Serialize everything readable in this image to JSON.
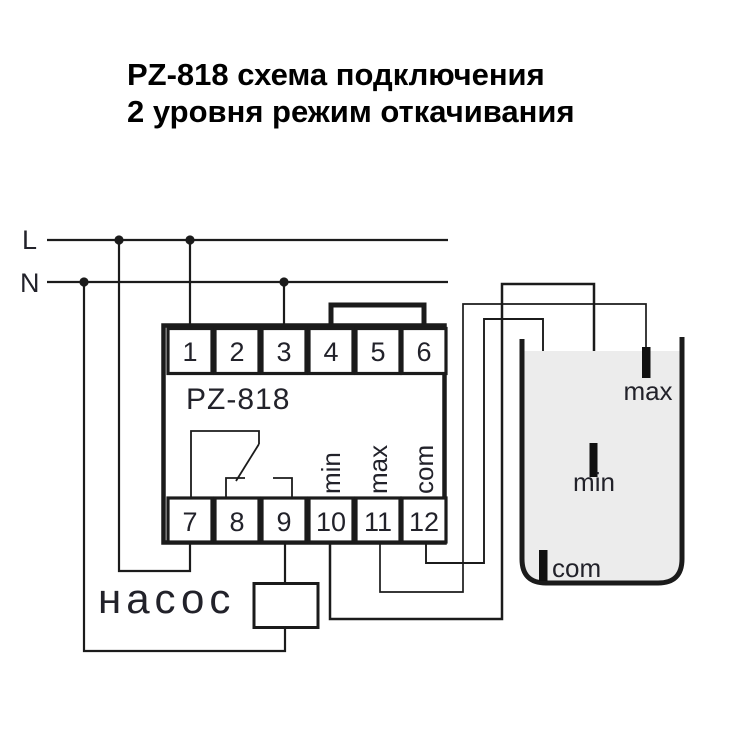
{
  "title": {
    "line1": "PZ-818 схема подключения",
    "line2": "2 уровня режим откачивания"
  },
  "power": {
    "l": "L",
    "n": "N"
  },
  "device": {
    "model": "PZ-818",
    "terminals_top": [
      "1",
      "2",
      "3",
      "4",
      "5",
      "6"
    ],
    "terminals_bottom": [
      "7",
      "8",
      "9",
      "10",
      "11",
      "12"
    ],
    "signals": [
      "min",
      "max",
      "com"
    ]
  },
  "pump": {
    "label": "насос"
  },
  "tank": {
    "electrode_max": "max",
    "electrode_min": "min",
    "electrode_com": "com"
  },
  "colors": {
    "line": "#1b1b1b",
    "text": "#22222a",
    "title": "#000000",
    "liquid": "#ececec",
    "background": "#ffffff"
  }
}
